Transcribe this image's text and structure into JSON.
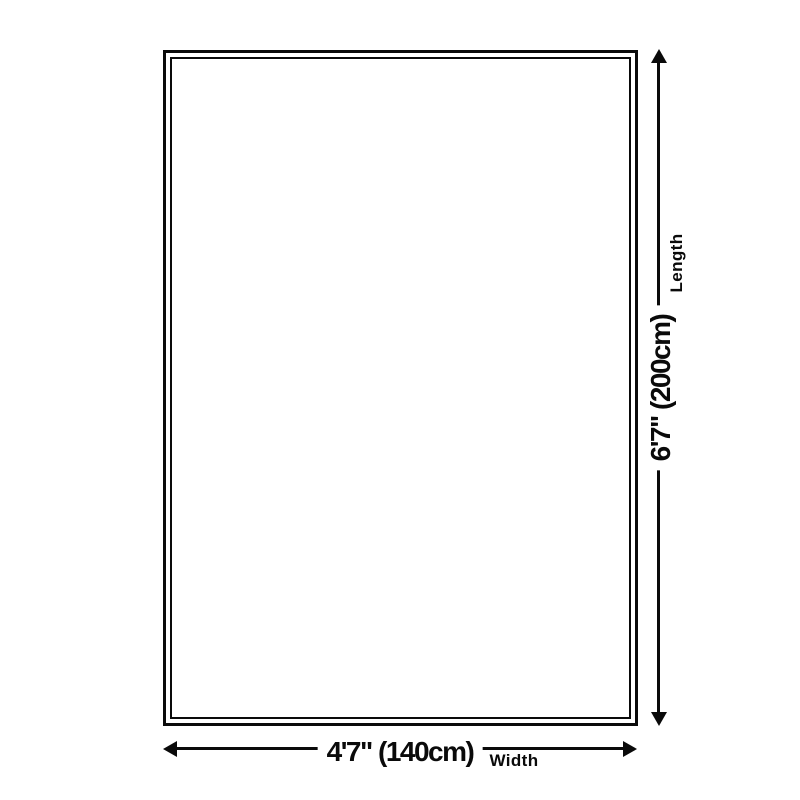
{
  "page": {
    "background_color": "#ffffff",
    "line_color": "#0a0a0a",
    "text_color": "#0a0a0a"
  },
  "diagram": {
    "type": "product-size-diagram",
    "shape": "rectangle-with-inner-border",
    "dimensions": {
      "length": {
        "value": "6'7\" (200cm)",
        "label": "Length"
      },
      "width": {
        "value": "4'7\" (140cm)",
        "label": "Width"
      }
    }
  }
}
